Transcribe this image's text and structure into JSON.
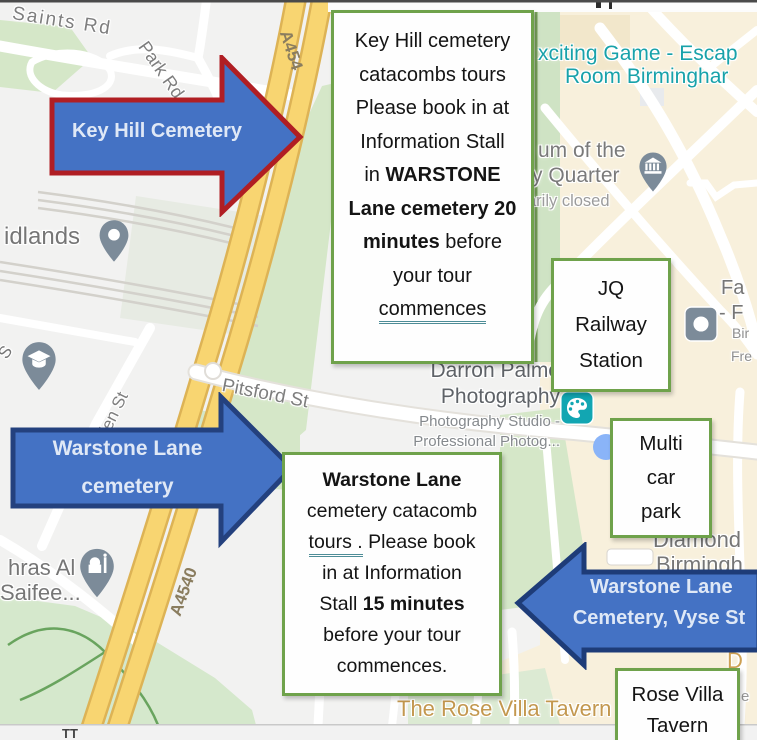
{
  "colors": {
    "arrow_fill": "#4472c4",
    "arrow_border_red": "#b01e23",
    "arrow_border_blue": "#1e3c78",
    "note_border_green": "#6fa24b",
    "road_yellow": "#f8d571",
    "map_green": "#d5e7c8",
    "poi_teal": "#18a2aa",
    "poi_orange": "#c3984f",
    "pin_gray": "#7c8b99"
  },
  "notes": {
    "key_hill": {
      "line1": "Key Hill cemetery",
      "line2": "catacombs tours",
      "line3": "Please book in at",
      "line4": "Information Stall",
      "line5_pre": "in ",
      "line5_bold": "WARSTONE",
      "line6_bold": "Lane cemetery 20",
      "line7_bold": "minutes",
      "line7_post": " before",
      "line8": "your tour",
      "line9_underlined": "commences"
    },
    "warstone": {
      "line1_bold": "Warstone Lane",
      "line2": "cemetery catacomb",
      "line3_underlined": "tours .",
      "line3_post": " Please book",
      "line4": "in at Information",
      "line5_pre": "Stall ",
      "line5_bold": "15 minutes",
      "line6": "before your tour",
      "line7": "commences."
    }
  },
  "boxes": {
    "jq_station": {
      "line1": "JQ",
      "line2": "Railway",
      "line3": "Station"
    },
    "car_park": {
      "line1": "Multi",
      "line2": "car",
      "line3": "park"
    },
    "rose_villa": {
      "line1": "Rose Villa",
      "line2": "Tavern"
    }
  },
  "arrows": {
    "key_hill": {
      "label": "Key Hill Cemetery"
    },
    "warstone": {
      "line1": "Warstone Lane",
      "line2": "cemetery"
    },
    "vyse": {
      "line1": "Warstone Lane",
      "line2": "Cemetery, Vyse St"
    }
  },
  "map_labels": {
    "saints_rd": "Saints Rd",
    "park_rd": "Park Rd S",
    "a454": "A454",
    "a4540": "A4540",
    "ellen_st": "Ellen St",
    "pitsford_st": "Pitsford St",
    "midlands": "idlands",
    "escape_line1": "xciting Game - Escap",
    "escape_line2": "Room Birminghar",
    "museum_line1": "um of the",
    "museum_line2": "y Quarter",
    "museum_status": "arily closed",
    "fa_fragment": "Fa",
    "f_fragment": "- F",
    "bir_fragment": "Bir",
    "fre_fragment": "Fre",
    "photo_line1": "Darron Palme",
    "photo_line2": "Photography",
    "photo_sub1": "Photography Studio -",
    "photo_sub2": "Professional Photog...",
    "diamond_line1": "Diamond",
    "diamond_line2": "Birmingh",
    "mosque_line1": "hras Al",
    "mosque_line2": "Saifee...",
    "tavern": "The Rose Villa Tavern",
    "d_fragment": "D",
    "e_fragment": "e",
    "s_fragment": "S",
    "tt_fragment": "TT"
  }
}
